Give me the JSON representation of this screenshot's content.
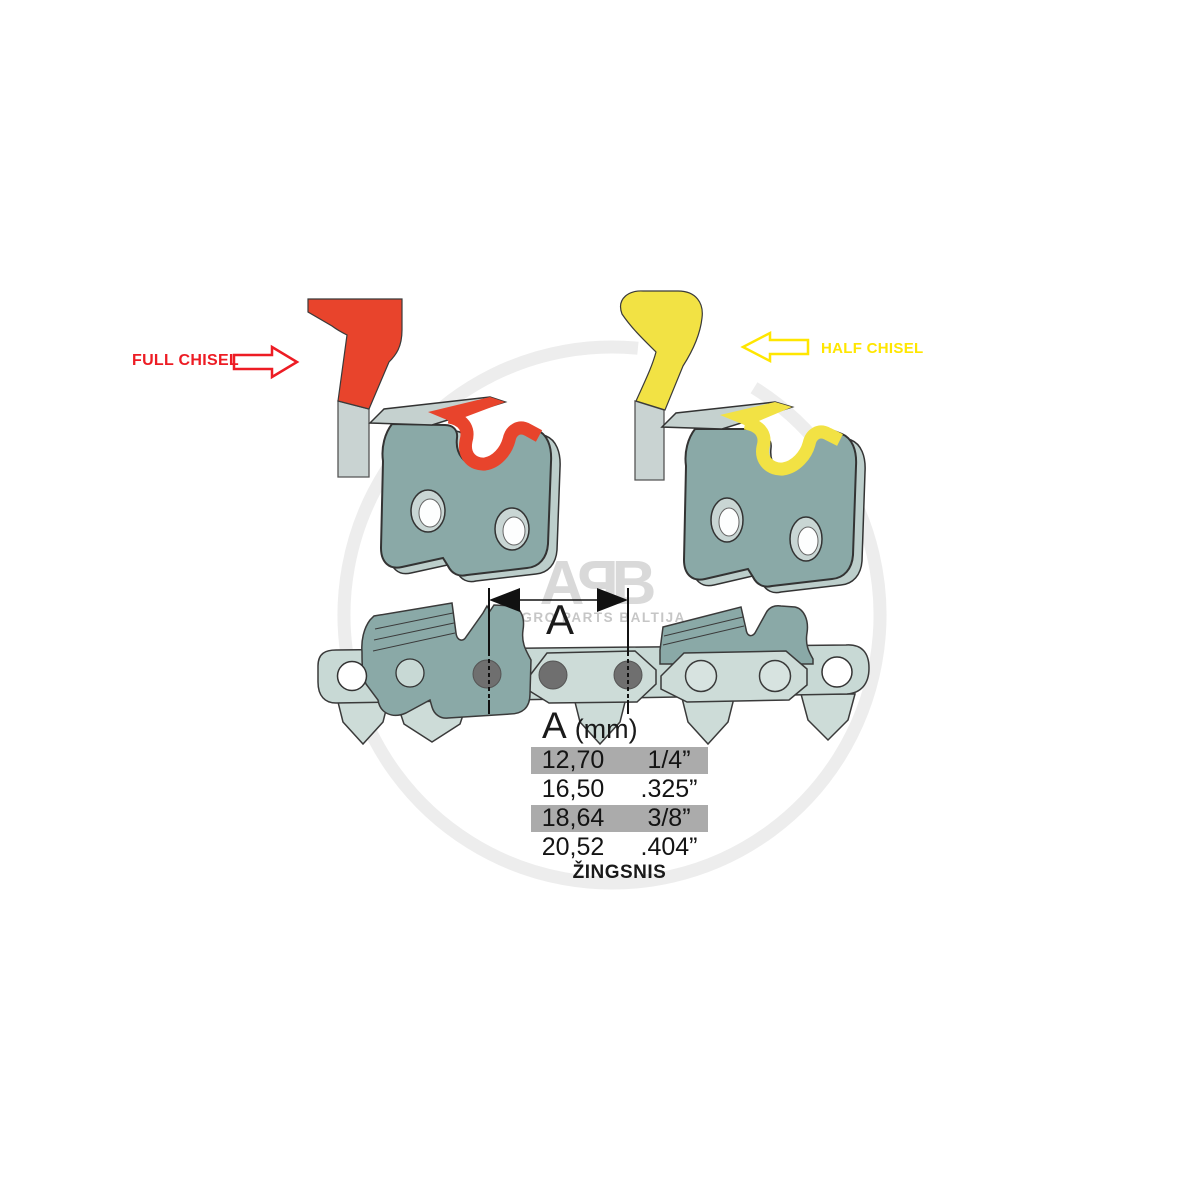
{
  "watermark": {
    "letters": [
      "A",
      "P",
      "B"
    ],
    "subtitle": "AGRO PARTS BALTIJA",
    "ring_color": "#ededed",
    "letter_color": "#d9d9d9",
    "subtitle_color": "#c6c6c6"
  },
  "labels": {
    "full_chisel": "FULL CHISEL",
    "half_chisel": "HALF CHISEL"
  },
  "dimension": {
    "label": "A"
  },
  "table": {
    "header_symbol": "A",
    "header_unit": "(mm)",
    "rows": [
      {
        "mm": "12,70",
        "inch": "1/4”",
        "highlighted": true
      },
      {
        "mm": "16,50",
        "inch": ".325”",
        "highlighted": false
      },
      {
        "mm": "18,64",
        "inch": "3/8”",
        "highlighted": true
      },
      {
        "mm": "20,52",
        "inch": ".404”",
        "highlighted": false
      }
    ],
    "highlight_color": "#ababab",
    "caption": "ŽINGSNIS"
  },
  "colors": {
    "full_chisel_accent": "#e8442c",
    "full_chisel_label": "#ed1c24",
    "half_chisel_accent": "#f2e244",
    "half_chisel_label": "#ffe600",
    "cutter_body": "#8aa9a7",
    "cutter_edge_3d": "#bccecb",
    "top_plate": "#c5d1cf",
    "link_light": "#c8d9d5",
    "drive_link": "#cddcd8",
    "rivet": "#6f6f6f",
    "stem_gray": "#c9d3d2",
    "dimension_ink": "#111111"
  }
}
